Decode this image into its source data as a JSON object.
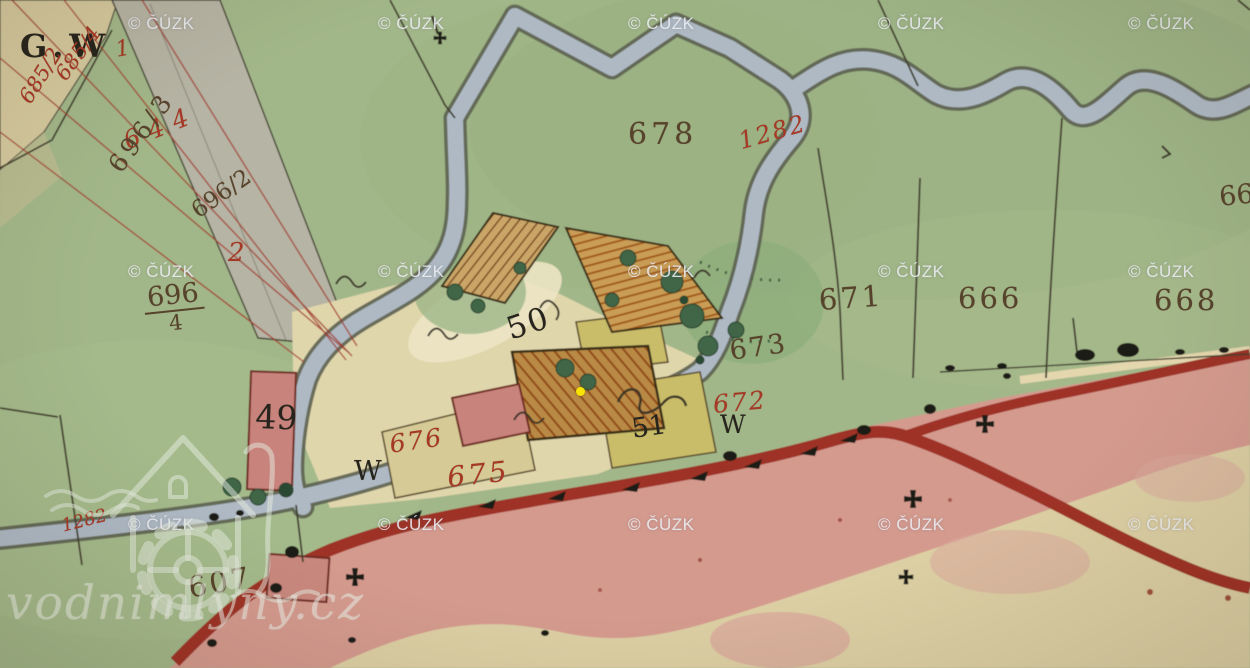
{
  "watermarks": {
    "cuzk": {
      "label": "© ČÚZK",
      "columns_x": [
        128,
        378,
        628,
        878,
        1128
      ],
      "rows_y": [
        14,
        262,
        515
      ]
    },
    "brand": {
      "label": "vodnimlyny.cz"
    }
  },
  "marker": {
    "x": 580,
    "y": 391,
    "color": "#f8e400"
  },
  "labels": {
    "gw": "G.W",
    "p685": "685",
    "r1": "1",
    "p685_4": "685/4",
    "p685_2": "685/2",
    "p644": "644",
    "p696_3": "696/3",
    "p696_2": "696/2",
    "r2": "2",
    "p696_4": {
      "num": "696",
      "den": "4"
    },
    "p678": "678",
    "p1282": "1282",
    "p1282b": "1282",
    "p671": "671",
    "p666": "666",
    "p668": "668",
    "p66": "66",
    "p673": "673",
    "p672": "672",
    "p676": "676",
    "p675": "675",
    "p607": "607",
    "h49": "49",
    "h50": "50",
    "h51": "51",
    "w_left": "W",
    "w_right": "W"
  },
  "palette": {
    "meadow_green": "#a2b789",
    "field_tan": "#d5c99e",
    "stream_blue": "#aeb9c4",
    "road_pink": "#d49a8e",
    "road_edge_red": "#9e3226",
    "masonry_pink": "#c8837b",
    "wood_hatch_orange": "#9c5a26",
    "plot_yellow": "#c9bd6b",
    "ink_red": "#a63826",
    "ink_brown": "#57432c",
    "ink_black": "#26241d",
    "marker_yellow": "#f8e400"
  }
}
